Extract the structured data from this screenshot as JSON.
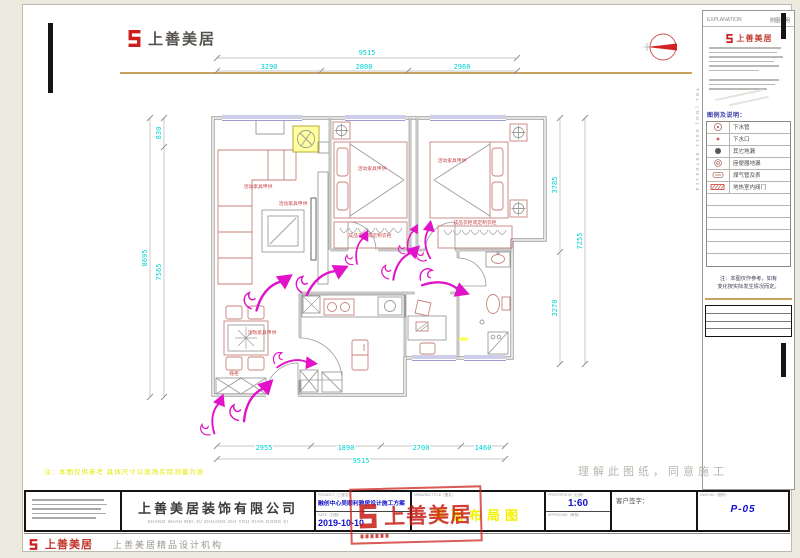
{
  "brand": {
    "name": "上善美居",
    "agency": "上善美居精品设计机构",
    "company": "上善美居装饰有限公司",
    "company_pinyin": "SHANG SHAN WEI JU ZHUANG SHI YOU XIAN GONG SI"
  },
  "notes": {
    "yellow_note": "注：本图仅供参考  具体尺寸以现场实际测量为准",
    "understand_note": "理解此图纸，同意施工"
  },
  "title_block": {
    "project_label": "PROJECT（工程名）",
    "project_name": "融创中心吴顺利雅居设计施工方案",
    "date_label": "DATE（日期）",
    "date_value": "2019-10-10",
    "drawing_title_label": "DRAWING TITLE（图名）",
    "drawing_title": "平面布局图",
    "proportion_label": "PROPORTION（比例）",
    "scale_value": "1:60",
    "approved_label": "APPROVED（审核）",
    "signature_label": "客户签字：",
    "dwg_label": "DWG NO（图号）",
    "page_no": "P-05",
    "stamp_text": "上善美居"
  },
  "right_panel": {
    "header_left": "EXPLANATION",
    "header_right": "附图说明",
    "logo_text": "上善美居",
    "legend_title": "图例及说明：",
    "legend": [
      {
        "label": "下水管"
      },
      {
        "label": "下水口"
      },
      {
        "label": "其它地漏"
      },
      {
        "label": "座便器地漏"
      },
      {
        "label": "煤气管及表"
      },
      {
        "label": "地热室内阀门"
      }
    ],
    "note_line1": "注：本图仅作参考，如有",
    "note_line2": "变化按实际发生情况而定。",
    "side_text": "TEL（NO）0311 80704114"
  },
  "plan": {
    "dims": {
      "top": {
        "total": "9515",
        "segments": [
          "3290",
          "2800",
          "2960"
        ]
      },
      "bottom": {
        "total": "9515",
        "segments": [
          "2955",
          "1890",
          "2700",
          "1460"
        ]
      },
      "left": {
        "total": "8695",
        "segments": [
          "830",
          "7565"
        ]
      },
      "right": {
        "total": "7255",
        "segments": [
          "3785",
          "3270"
        ]
      }
    },
    "labels": [
      {
        "text": "活动家具甲供"
      },
      {
        "text": "活动家具甲供"
      },
      {
        "text": "活动家具甲供"
      },
      {
        "text": "活动家具甲供"
      },
      {
        "text": "成品衣柜或定制衣柜"
      },
      {
        "text": "成品衣柜或定制衣柜"
      },
      {
        "text": "活动家具甲供"
      },
      {
        "text": "鞋柜"
      }
    ]
  },
  "colors": {
    "dimension_text": "#00d2d2",
    "flow_arrow": "#e112c8",
    "furniture_red": "#c9827b",
    "brand_red": "#cc2020",
    "title_yellow": "#f2f200",
    "value_blue": "#1111cc"
  }
}
